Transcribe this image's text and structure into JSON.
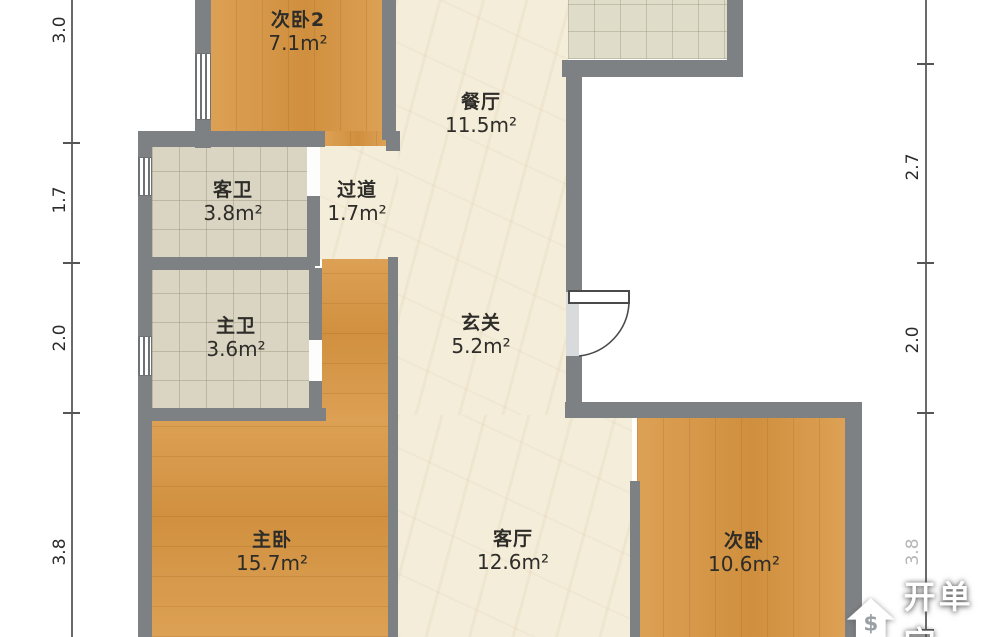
{
  "rooms": {
    "bedroom2": {
      "name": "次卧2",
      "area": "7.1m²"
    },
    "dining": {
      "name": "餐厅",
      "area": "11.5m²"
    },
    "guest_bath": {
      "name": "客卫",
      "area": "3.8m²"
    },
    "corridor": {
      "name": "过道",
      "area": "1.7m²"
    },
    "master_bath": {
      "name": "主卫",
      "area": "3.6m²"
    },
    "entry": {
      "name": "玄关",
      "area": "5.2m²"
    },
    "master_bedroom": {
      "name": "主卧",
      "area": "15.7m²"
    },
    "living": {
      "name": "客厅",
      "area": "12.6m²"
    },
    "bedroom": {
      "name": "次卧",
      "area": "10.6m²"
    }
  },
  "dimensions": {
    "left": [
      "3.0",
      "1.7",
      "2.0",
      "3.8"
    ],
    "right": [
      "2.7",
      "2.0",
      "3.8"
    ]
  },
  "watermark": {
    "text": "开单宝",
    "symbol": "$"
  },
  "colors": {
    "wall": "#7e8184",
    "wood_floor": "#d99c4c",
    "marble_floor": "#f4edda",
    "bath_tile": "#d9d5c2",
    "kitchen_tile": "#dfddc9"
  }
}
